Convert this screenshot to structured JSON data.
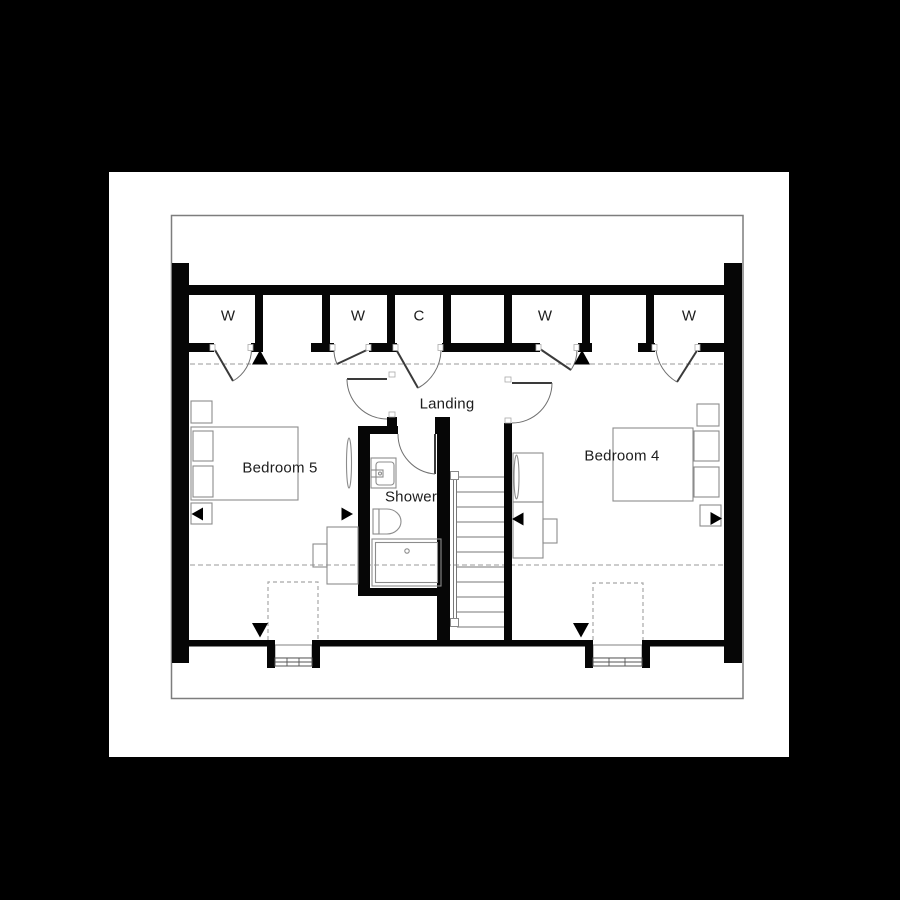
{
  "floorplan": {
    "rooms": {
      "bedroom5": {
        "label": "Bedroom 5"
      },
      "bedroom4": {
        "label": "Bedroom 4"
      },
      "landing": {
        "label": "Landing"
      },
      "shower": {
        "label": "Shower"
      }
    },
    "closets": [
      {
        "label": "W"
      },
      {
        "label": "W"
      },
      {
        "label": "C"
      },
      {
        "label": "W"
      },
      {
        "label": "W"
      }
    ],
    "colors": {
      "canvas": "#000000",
      "paper": "#ffffff",
      "wall": "#060606",
      "furniture_line": "#8c8c8c",
      "dashed_line": "#9a9a9a",
      "border": "#7d7d7d",
      "text": "#1c1c1c"
    }
  }
}
